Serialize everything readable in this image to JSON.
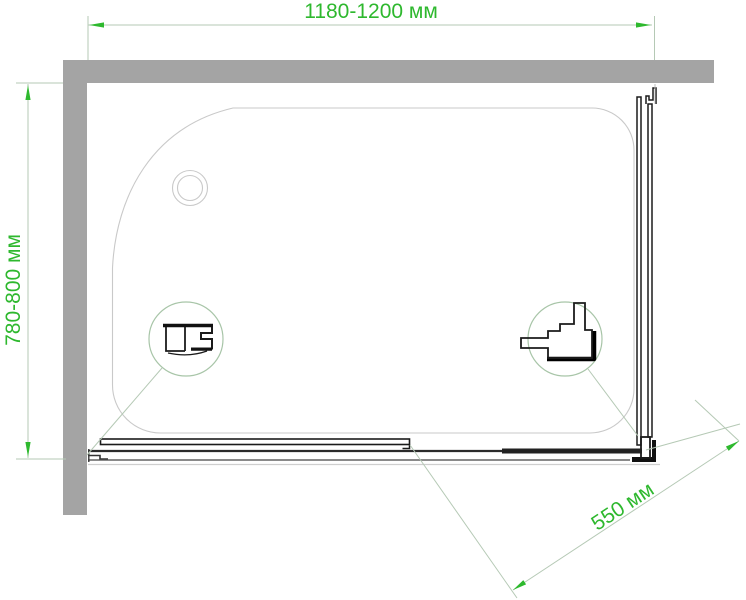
{
  "drawing": {
    "description_labels": {
      "width": "1180-1200 мм",
      "depth": "780-800 мм",
      "door": "550 мм"
    }
  },
  "dimensions": {
    "width": {
      "label": "1180-1200 мм"
    },
    "depth": {
      "label": "780-800 мм"
    },
    "door": {
      "label": "550 мм"
    }
  },
  "icons": {
    "left_detail": "wall-profile-section-icon",
    "right_detail": "corner-roller-profile-icon"
  },
  "colors": {
    "dimension_text_green": "#2eb82e",
    "dimension_line_green": "#b5c9b5",
    "arrow_green": "#2eb92e",
    "wall_gray": "#a4a4a4",
    "tray_outline_gray": "#c9c9c9",
    "drawing_black": "#1b1b1b",
    "background": "#ffffff"
  }
}
